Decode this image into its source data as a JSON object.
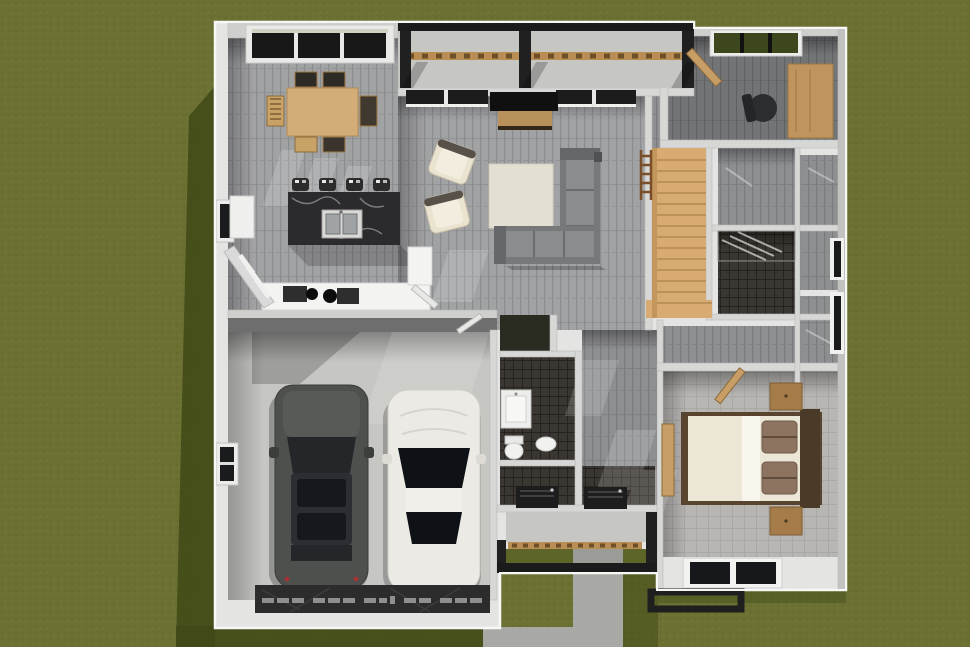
{
  "scene": {
    "type": "3d-floor-plan-overhead-render",
    "description": "Overhead dollhouse view of a single-story house on a grass lot, sunlight from upper right casting shadows to the lower left",
    "rooms": [
      "dining area",
      "kitchen",
      "pantry",
      "living room",
      "back porch",
      "home office",
      "stair hall",
      "hall bathroom",
      "closets",
      "powder bath",
      "laundry mud room",
      "foyer",
      "front porch",
      "master bedroom",
      "two car garage"
    ],
    "furniture": [
      "dining table with six chairs",
      "kitchen island with double sink and four bar stools",
      "kitchen counter with cooktop",
      "sectional sofa",
      "two cream armchairs",
      "area rug",
      "wall tv with console",
      "wood staircase with railing",
      "office desk and chair",
      "king bed with brown pillows",
      "two nightstands",
      "bedroom bench",
      "washer and dryer",
      "toilet",
      "vanity",
      "shower"
    ],
    "vehicles": [
      "dark gray SUV",
      "white sedan"
    ]
  },
  "colors": {
    "grass": "#6c7133",
    "grass_shadow": "#3f4816",
    "wall_outer": "#e4e4e3",
    "walkway": "#a8a9a5",
    "concrete": "#c6c7c3",
    "beam": "#1b1b1b",
    "trim_wood": "#b98e55",
    "table_wood": "#d2ad77",
    "island": "#2b2b2d",
    "counter": "#f3f3f2",
    "sofa": "#76787a",
    "armchair": "#eae3d0",
    "rug": "#e3dfd2",
    "stair_wood": "#d7ab72",
    "desk_wood": "#bf955d",
    "bed_duvet": "#ece6d6",
    "bed_pillow": "#8d7460",
    "bed_frame": "#59452f",
    "nightstand": "#a57c49",
    "suv": "#4e504e",
    "sedan": "#eceae4",
    "tile_dark": "#3a3631",
    "door_wood": "#c79e66"
  }
}
